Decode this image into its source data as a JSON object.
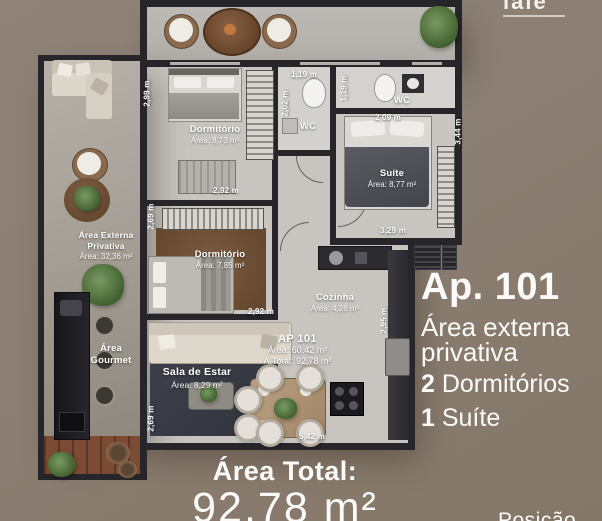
{
  "brand": {
    "logo_fragment": "iaie"
  },
  "info_panel": {
    "title": "Ap. 101",
    "subtitle_line1": "Área externa",
    "subtitle_line2": "privativa",
    "features": [
      {
        "number": "2",
        "label": " Dormitórios"
      },
      {
        "number": "1",
        "label": " Suíte"
      }
    ]
  },
  "total_banner": {
    "label": "Área Total:",
    "value": "92,78 m²"
  },
  "footer": {
    "partial_text": "Posição"
  },
  "unit_stamp": {
    "name": "AP 101",
    "area": "Área: 60,42 m²",
    "total": "Á.Total: 92,78 m²"
  },
  "rooms": {
    "dormitorio1": {
      "name": "Dormitório",
      "area": "Área: 8,73 m²",
      "width": "2,92 m",
      "height": "2,99 m"
    },
    "wc1": {
      "name": "WC",
      "width": "1,19 m",
      "height": "2,02 m"
    },
    "wc2": {
      "name": "WC",
      "width": "2,09 m",
      "height": "1,19 m"
    },
    "suite": {
      "name": "Suíte",
      "area": "Área: 8,77 m²",
      "width": "3,29 m",
      "height": "3,44 m"
    },
    "dormitorio2": {
      "name": "Dormitório",
      "area": "Área: 7,85 m²",
      "width": "2,92 m",
      "height": "2,69 m"
    },
    "cozinha": {
      "name": "Cozinha",
      "area": "Área: 4,26 m²",
      "height": "2,95 m"
    },
    "sala": {
      "name": "Sala de Estar",
      "area": "Área: 8,29 m²",
      "width": "5,42 m",
      "height": "2,69 m"
    },
    "area_externa": {
      "name_line1": "Área Externa",
      "name_line2": "Privativa",
      "area": "Área: 32,36 m²"
    },
    "area_gourmet": {
      "name_line1": "Área",
      "name_line2": "Gourmet"
    }
  },
  "colors": {
    "background": "#8a7d71",
    "wall": "#26252a",
    "floor": "#c8c5c1",
    "accent_text": "#ffffff"
  }
}
